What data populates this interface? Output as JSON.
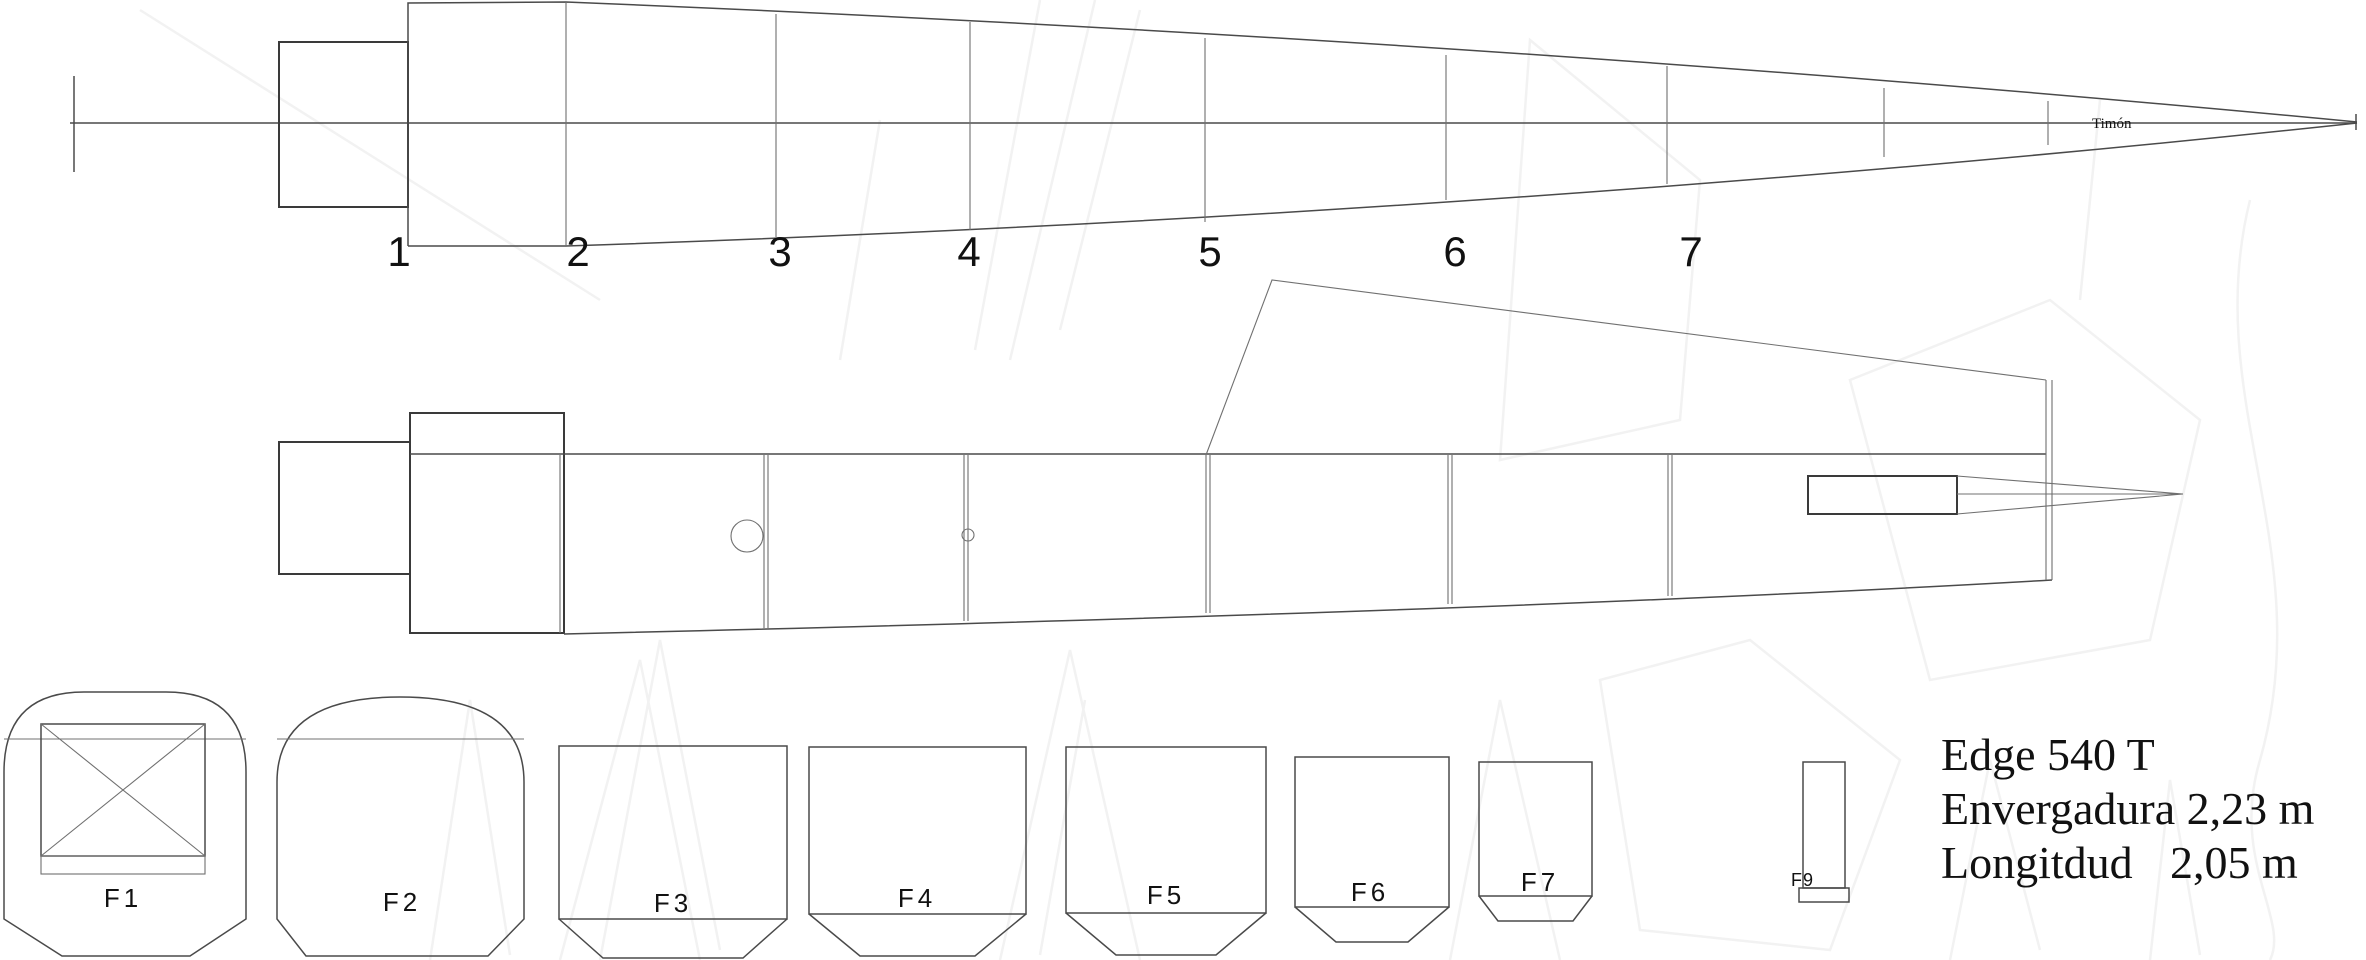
{
  "title_block": {
    "model": "Edge 540 T",
    "wingspan_line": "Envergadura 2,23 m",
    "length_label": "Longitdud",
    "length_value": "2,05 m"
  },
  "annotations": {
    "rudder_label": "Timón"
  },
  "side_view": {
    "stations": [
      "1",
      "2",
      "3",
      "4",
      "5",
      "6",
      "7"
    ]
  },
  "formers": {
    "labels": [
      "F1",
      "F2",
      "F3",
      "F4",
      "F5",
      "F6",
      "F7",
      "F9"
    ]
  },
  "colors": {
    "background": "#ffffff",
    "line": "#4a4a4a",
    "line_dark": "#3a3a3a",
    "text": "#111111",
    "watermark": "#f2f2f2"
  }
}
